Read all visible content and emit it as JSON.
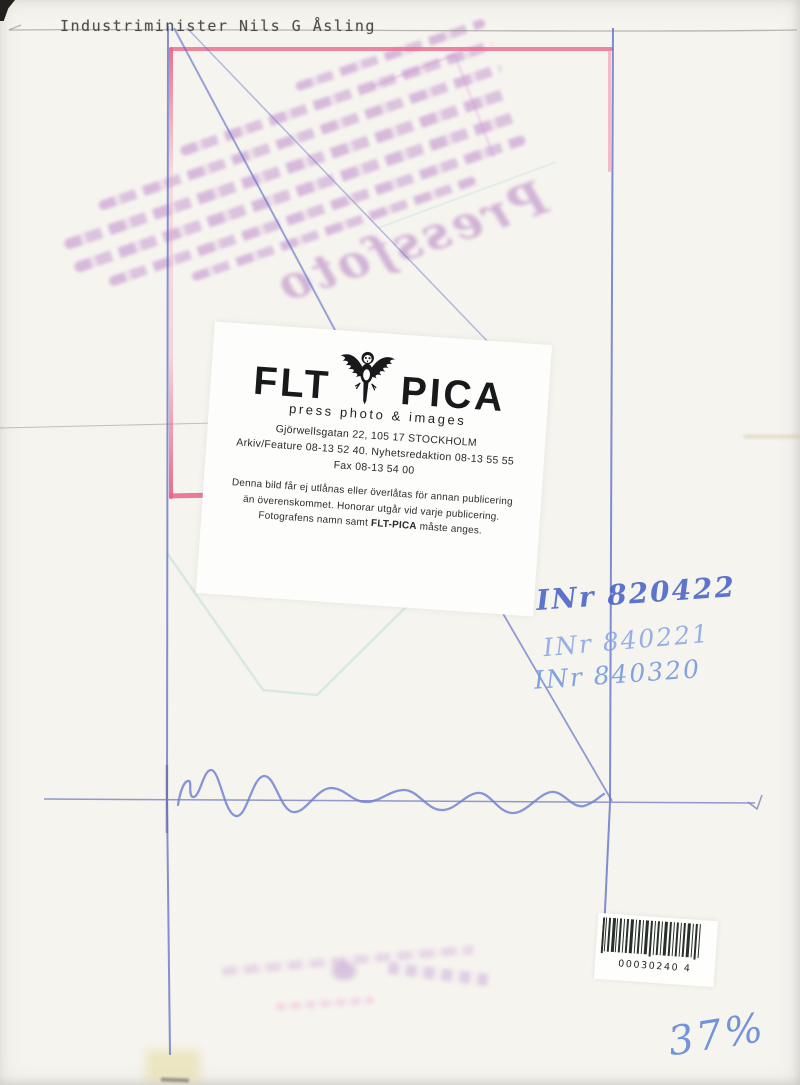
{
  "caption": {
    "text": "Industriminister Nils G Åsling"
  },
  "agency_label": {
    "brand_left": "FLT",
    "brand_right": "PICA",
    "tagline": "press photo & images",
    "address_line1": "Gjörwellsgatan 22, 105 17 STOCKHOLM",
    "phone_line": "Arkiv/Feature 08-13 52 40. Nyhetsredaktion 08-13 55 55",
    "fax_line": "Fax 08-13 54 00",
    "terms_line1": "Denna bild får ej utlånas eller överlåtas för annan publicering",
    "terms_line2": "än överenskommet. Honorar utgår vid varje publicering.",
    "terms_line3_prefix": "Fotografens namn samt ",
    "terms_brand": "FLT-PICA",
    "terms_line3_suffix": " måste anges."
  },
  "handwriting": {
    "archive_number_1": "INr 820422",
    "archive_number_2": "INr 840221",
    "archive_number_3": "INr 840320",
    "scale_note": "37%"
  },
  "barcode": {
    "digits": "00030240 4"
  },
  "ghost_stamp": {
    "legible_word": "Pressfoto"
  },
  "colors": {
    "pen_blue": "#5b6fc9",
    "pen_light_blue": "#7d9ce0",
    "crop_pink": "#ee7f9b",
    "stamp_purple": "#a86fc0",
    "paper": "#f6f4ef"
  }
}
